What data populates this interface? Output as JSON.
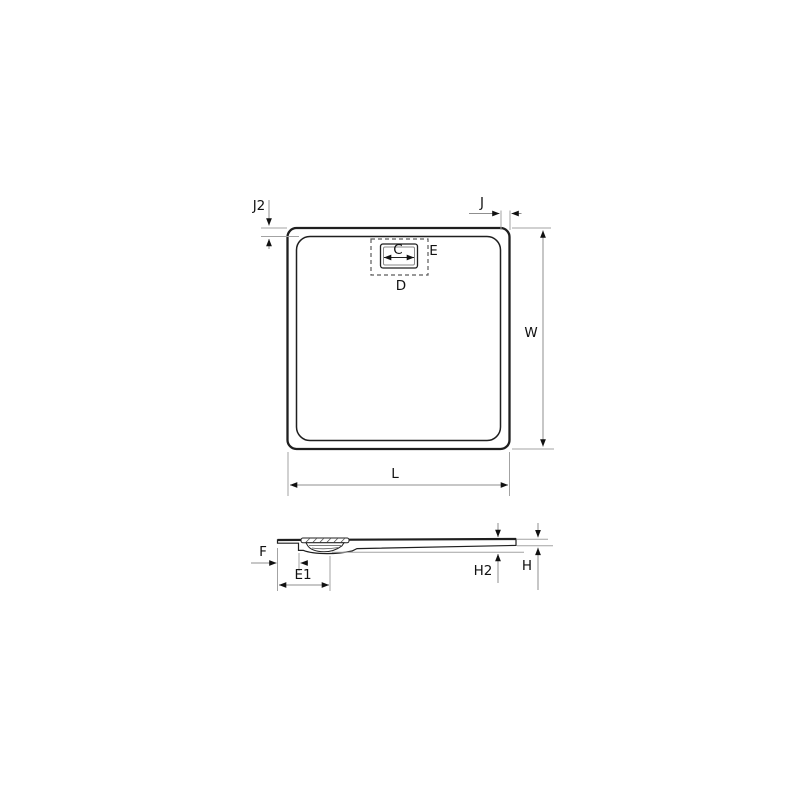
{
  "drawing": {
    "top_view": {
      "labels": {
        "j2": "J2",
        "j": "J",
        "c": "C",
        "e": "E",
        "d": "D",
        "w": "W",
        "l": "L"
      }
    },
    "side_view": {
      "labels": {
        "f": "F",
        "e1": "E1",
        "h2": "H2",
        "h": "H"
      }
    },
    "colors": {
      "outline": "#1f1f1f",
      "dimension_line": "#8f8f8f",
      "extension_line": "#a3a3a3",
      "arrowhead": "#111111",
      "label_text": "#111111",
      "background": "#ffffff"
    }
  }
}
